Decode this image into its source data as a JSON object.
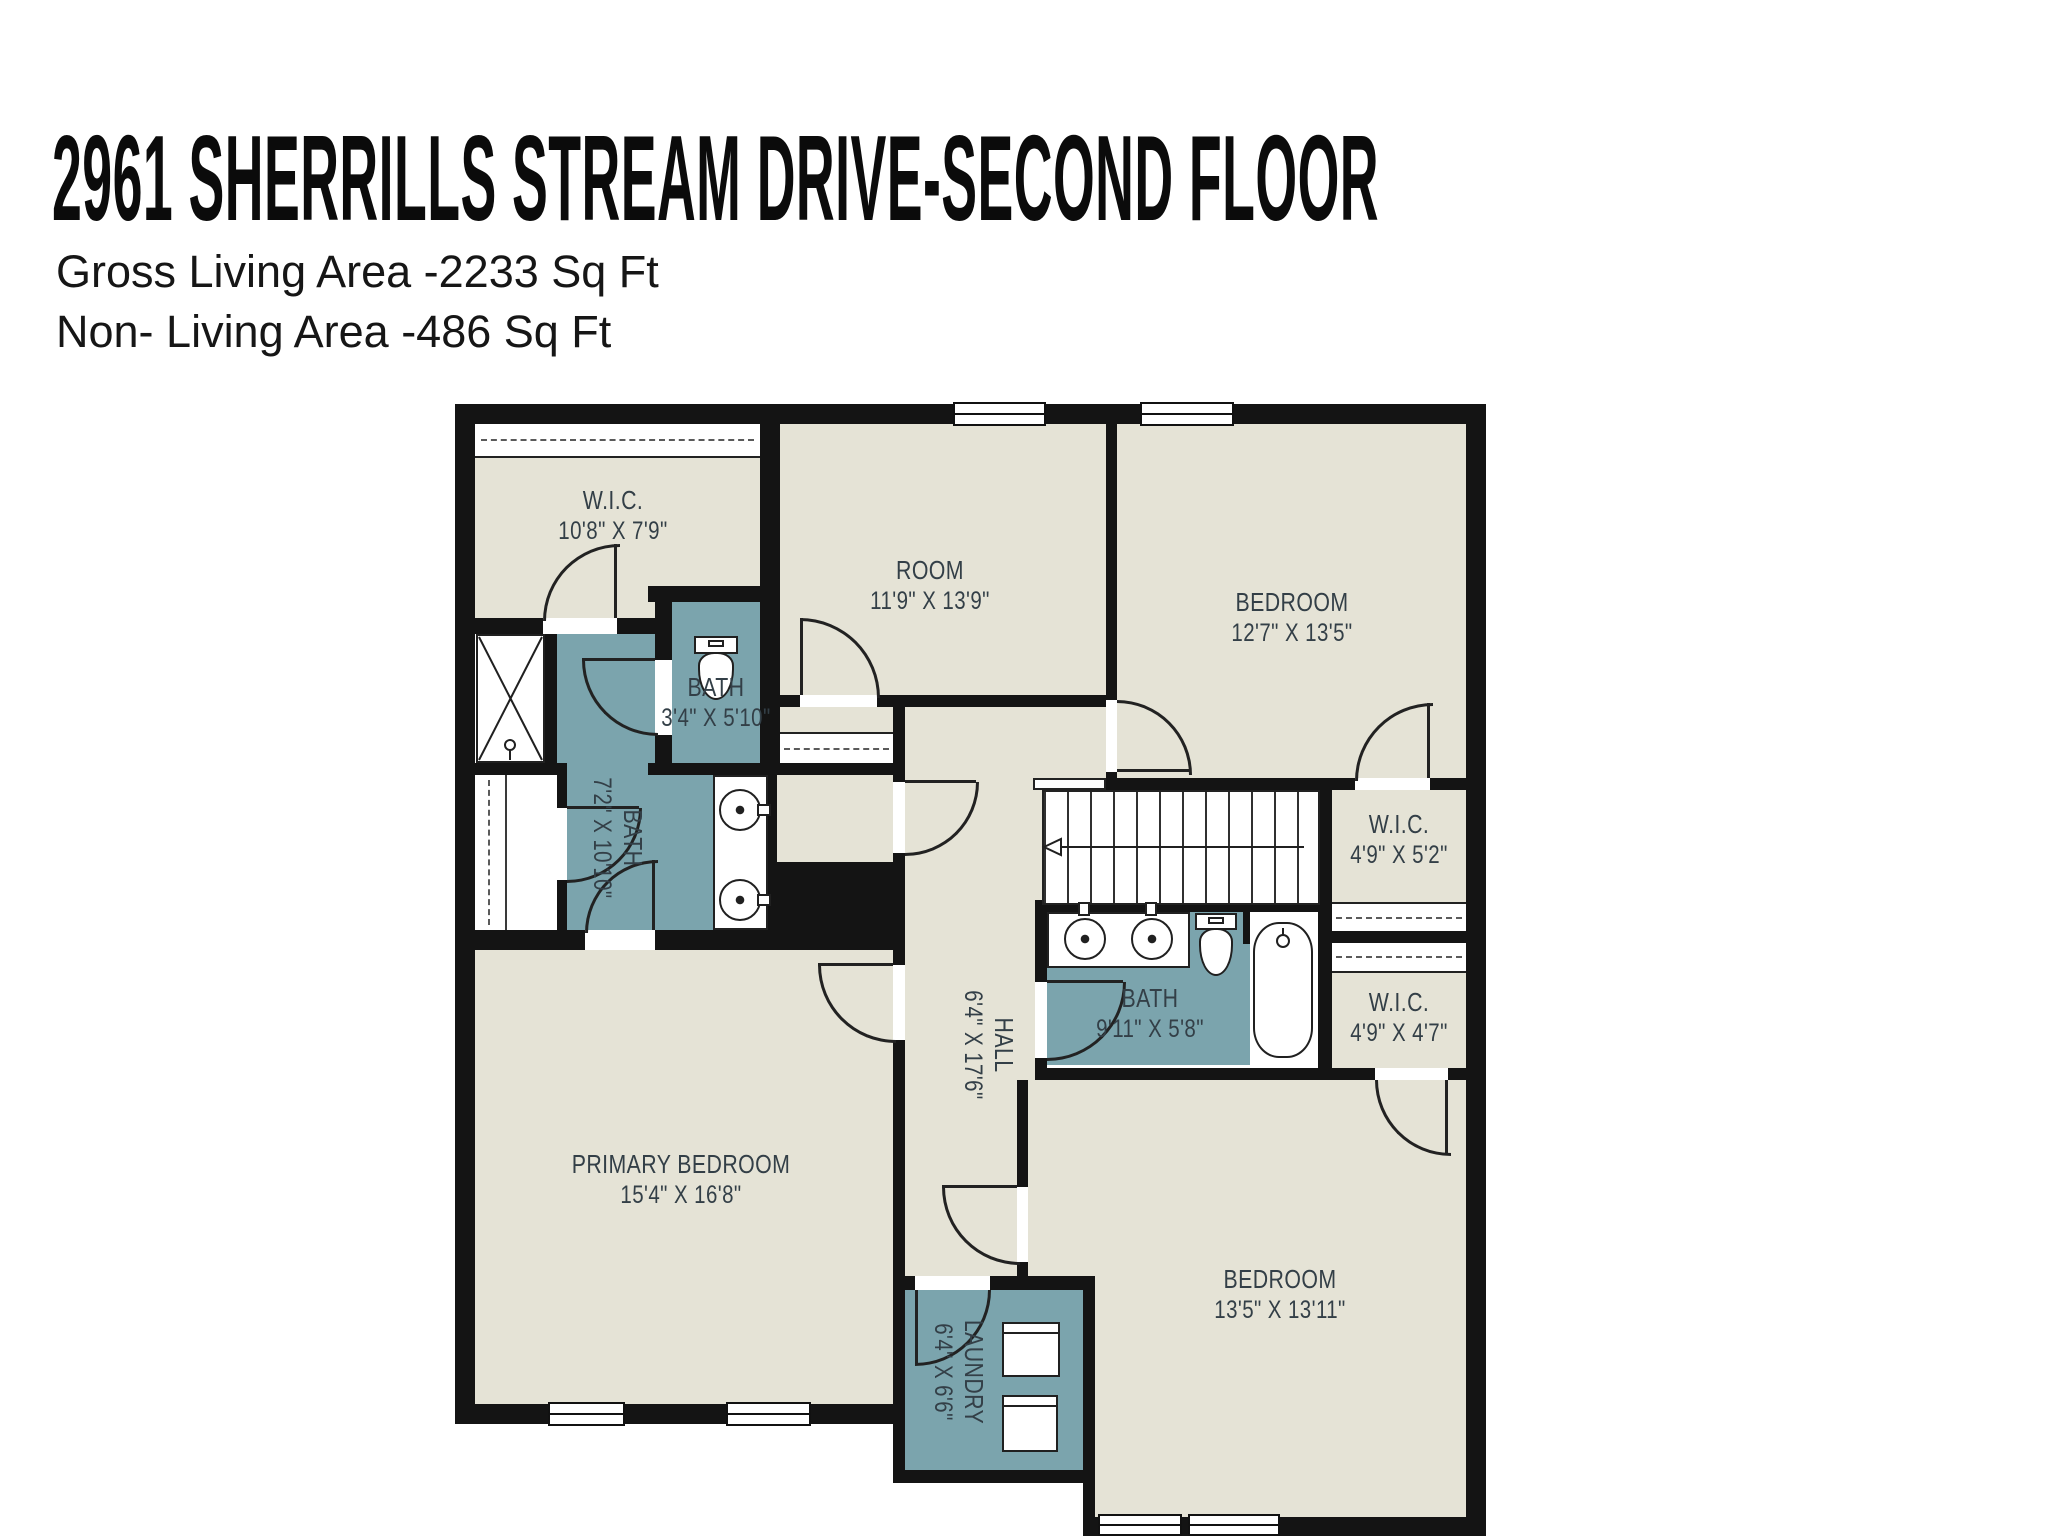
{
  "header": {
    "title": "2961 SHERRILLS STREAM DRIVE-SECOND FLOOR",
    "gross_living_area": "Gross Living Area -2233 Sq Ft",
    "non_living_area": "Non- Living Area -486 Sq Ft"
  },
  "colors": {
    "room_fill": "#e5e3d6",
    "wet_room_fill": "#7ba4ad",
    "wall": "#141414",
    "door_line": "#222222",
    "label_text": "#333f47"
  },
  "rooms": [
    {
      "name": "W.I.C.",
      "dims": "10'8\" X 7'9\""
    },
    {
      "name": "ROOM",
      "dims": "11'9\" X 13'9\""
    },
    {
      "name": "BEDROOM",
      "dims": "12'7\" X 13'5\""
    },
    {
      "name": "BATH",
      "dims": "3'4\" X 5'10\""
    },
    {
      "name": "BATH",
      "dims": "7'2\" X 10'10\""
    },
    {
      "name": "W.I.C.",
      "dims": "4'9\" X 5'2\""
    },
    {
      "name": "BATH",
      "dims": "9'11\" X 5'8\""
    },
    {
      "name": "W.I.C.",
      "dims": "4'9\" X 4'7\""
    },
    {
      "name": "HALL",
      "dims": "6'4\" X 17'6\""
    },
    {
      "name": "PRIMARY BEDROOM",
      "dims": "15'4\" X 16'8\""
    },
    {
      "name": "BEDROOM",
      "dims": "13'5\" X 13'11\""
    },
    {
      "name": "LAUNDRY",
      "dims": "6'4\" X 6'6\""
    }
  ]
}
